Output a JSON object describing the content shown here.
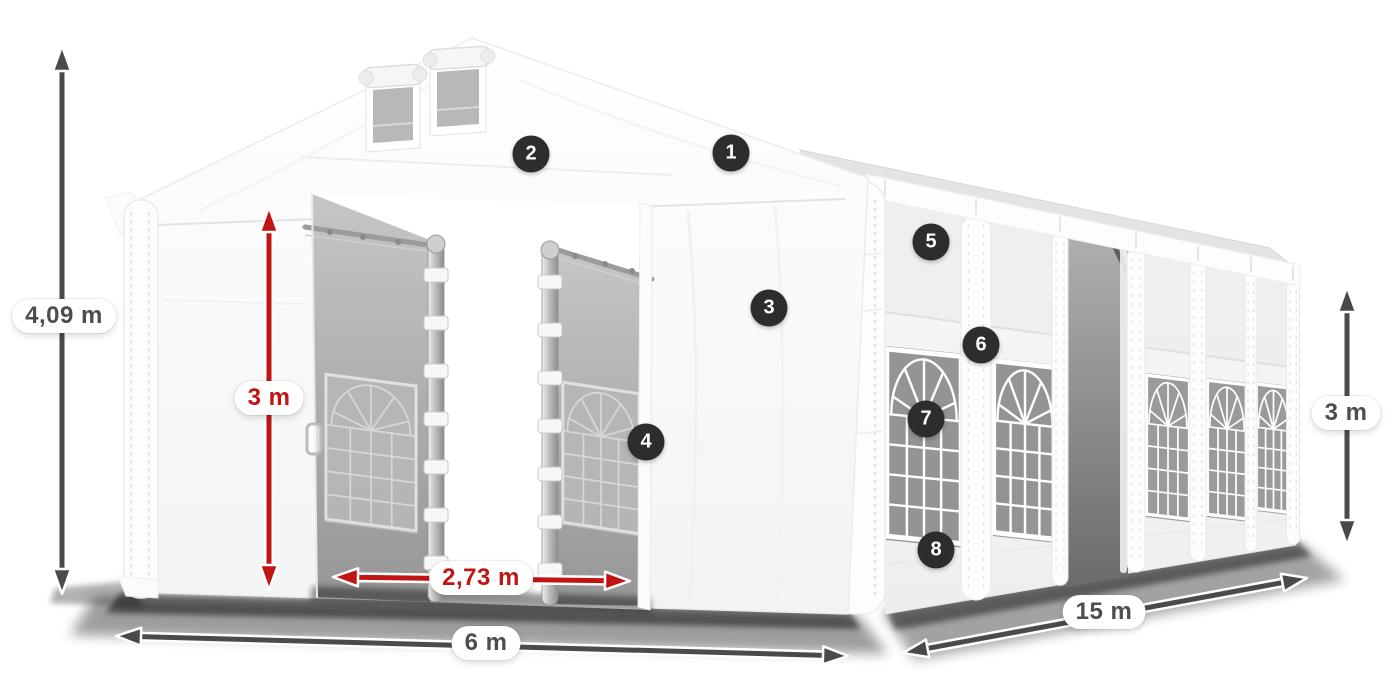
{
  "dimensions": {
    "total_height": {
      "label": "4,09 m",
      "color": "gray"
    },
    "entrance_height": {
      "label": "3 m",
      "color": "red"
    },
    "entrance_width": {
      "label": "2,73 m",
      "color": "red"
    },
    "width": {
      "label": "6 m",
      "color": "gray"
    },
    "length": {
      "label": "15 m",
      "color": "gray"
    },
    "side_height": {
      "label": "3 m",
      "color": "gray"
    }
  },
  "callouts": [
    {
      "number": "1"
    },
    {
      "number": "2"
    },
    {
      "number": "3"
    },
    {
      "number": "4"
    },
    {
      "number": "5"
    },
    {
      "number": "6"
    },
    {
      "number": "7"
    },
    {
      "number": "8"
    }
  ],
  "colors": {
    "background": "#ffffff",
    "dimension_red": "#c11414",
    "dimension_gray": "#4a4a4a",
    "label_text": "#4d4d4d",
    "badge_background": "#2d2d2d",
    "badge_text": "#ffffff",
    "tent_white": "#f8f8f8",
    "interior_gray": "#a8a8a8"
  }
}
